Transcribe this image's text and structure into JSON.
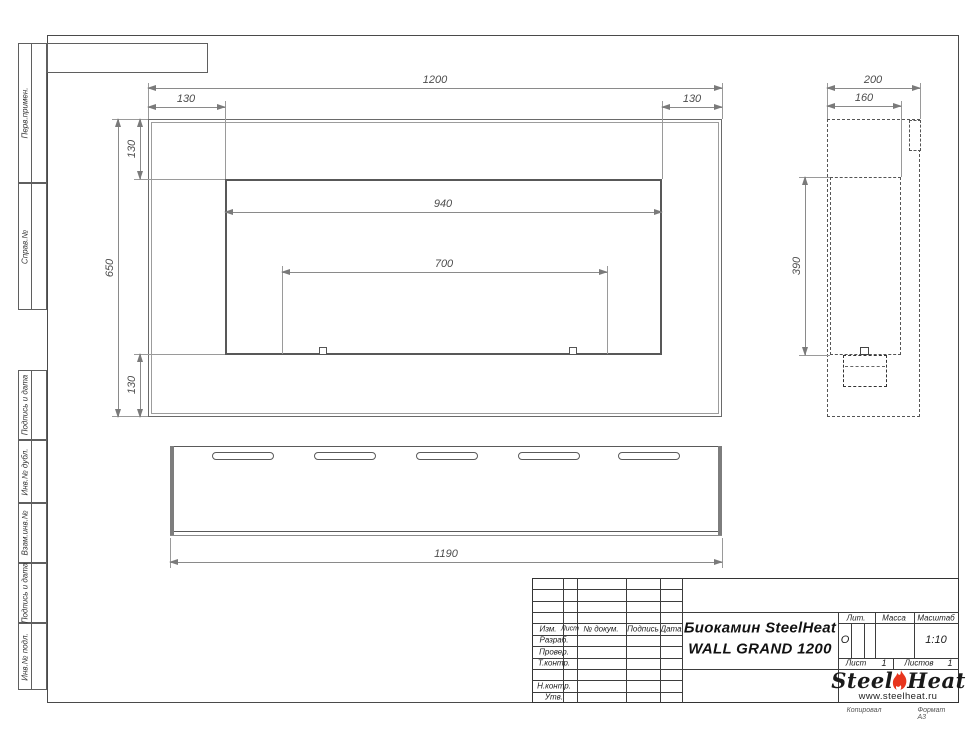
{
  "dims": {
    "front_width": "1200",
    "front_offset_left": "130",
    "front_offset_right": "130",
    "front_height": "650",
    "front_offset_top": "130",
    "front_offset_bottom": "130",
    "opening_width": "940",
    "burner_span": "700",
    "side_depth": "200",
    "side_inner_depth": "160",
    "side_opening_height": "390",
    "bottom_length": "1190"
  },
  "margin_labels": [
    "Перв.примен.",
    "Справ.№",
    "Подпись и дата",
    "Инв.№ дубл.",
    "Взам.инв.№",
    "Подпись и дата",
    "Инв.№ подл."
  ],
  "title_block": {
    "product_line1": "Биокамин SteelHeat",
    "product_line2": "WALL GRAND 1200",
    "col_izm": "Изм.",
    "col_list": "Лист",
    "col_doc": "№ докум.",
    "col_sign": "Подпись",
    "col_date": "Дата",
    "row_razrab": "Разраб.",
    "row_prover": "Провер.",
    "row_tkontr": "Т.контр.",
    "row_nkontr": "Н.контр.",
    "row_utv": "Утв.",
    "lit_label": "Лит.",
    "lit_value": "О",
    "mass_label": "Масса",
    "scale_label": "Масштаб",
    "scale_value": "1:10",
    "sheet_label": "Лист",
    "sheet_value": "1",
    "sheets_label": "Листов",
    "sheets_value": "1",
    "logo_steel": "Steel",
    "logo_heat": "Heat",
    "logo_url": "www.steelheat.ru",
    "footer_copied": "Копировал",
    "footer_format": "Формат А3"
  },
  "colors": {
    "flame_red": "#e8351d",
    "drawing_line": "#6a6a6a",
    "dim_text": "#4d4d4d"
  }
}
